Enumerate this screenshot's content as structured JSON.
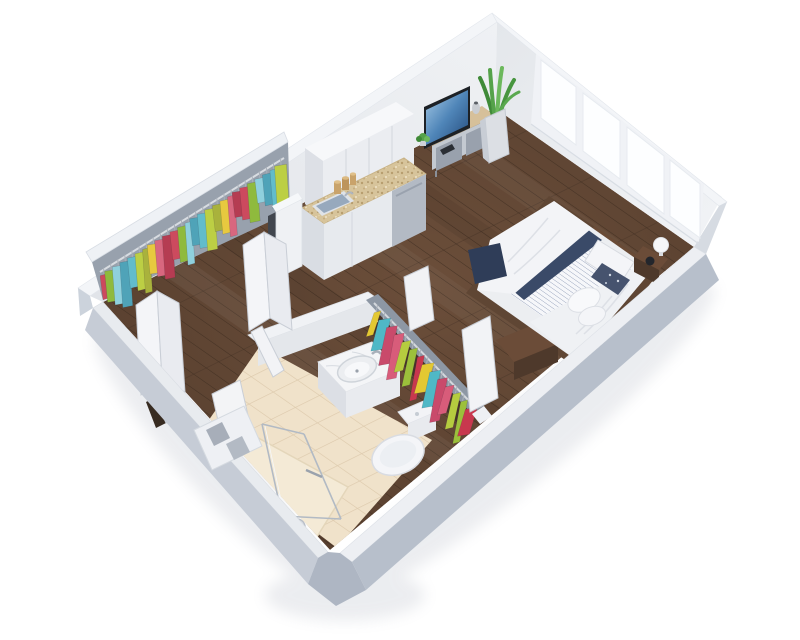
{
  "title": "3D isometric studio apartment floor plan render",
  "scene": {
    "background": "#ffffff",
    "view": "isometric-cutaway-dollhouse",
    "colors": {
      "wall_top": "#f3f5f8",
      "wall_outer_left": "#c3cad5",
      "wall_outer_right": "#b8c0cc",
      "wall_inner": "#e8eaee",
      "wood_floor": "#5b4232",
      "wood_seam": "#3f2d20",
      "tile_floor": "#f0e2ca",
      "tile_grout": "#ddcaad",
      "shower_floor": "#f4ead6",
      "granite_counter": "#d7c49b",
      "cabinet_white": "#ebedf1",
      "navy_bedding": "#3a4a68",
      "duvet_white": "#f3f4f7",
      "frame_wood": "#5f4634",
      "tv_screen_blue": "#2a5b8f",
      "plant_green": "#55a24a"
    },
    "rooms": [
      {
        "name": "main-room",
        "floor": "dark-wood"
      },
      {
        "name": "bathroom",
        "floor": "beige-tile"
      },
      {
        "name": "shower",
        "floor": "cream"
      },
      {
        "name": "entry",
        "floor": "dark-wood"
      },
      {
        "name": "closet-1",
        "location": "back-left-wall"
      },
      {
        "name": "closet-2",
        "location": "beside-bathroom"
      }
    ],
    "furniture": [
      "double-bed",
      "nightstand",
      "table-lamp",
      "tv-stand",
      "television",
      "floor-plant",
      "kitchen-upper-cabinets",
      "kitchen-counter-with-sink",
      "dishwasher",
      "bathroom-vanity-sink",
      "toilet",
      "shower-glass-panel",
      "hand-shower",
      "foot-bench",
      "bifold-closet-doors",
      "niche-shelf"
    ],
    "windows": {
      "count": 4,
      "wall": "back-right"
    },
    "closet1": {
      "rail": [
        100,
        272,
        284,
        158
      ],
      "count": 26,
      "lean": 3,
      "clothes_colors": [
        "#cc4a5e",
        "#e7c93f",
        "#62bccb",
        "#8fba3d",
        "#d8677f",
        "#bccf44",
        "#8fd0dd",
        "#b53c52",
        "#a9b23c",
        "#4fa3b8"
      ]
    },
    "closet2": {
      "rail": [
        374,
        303,
        475,
        407
      ],
      "count": 14,
      "lean": -8,
      "clothes_colors": [
        "#e3c832",
        "#9cc03b",
        "#d85c7a",
        "#4fb8c6",
        "#c8384e",
        "#b5cc3f",
        "#c94a6b"
      ]
    }
  }
}
